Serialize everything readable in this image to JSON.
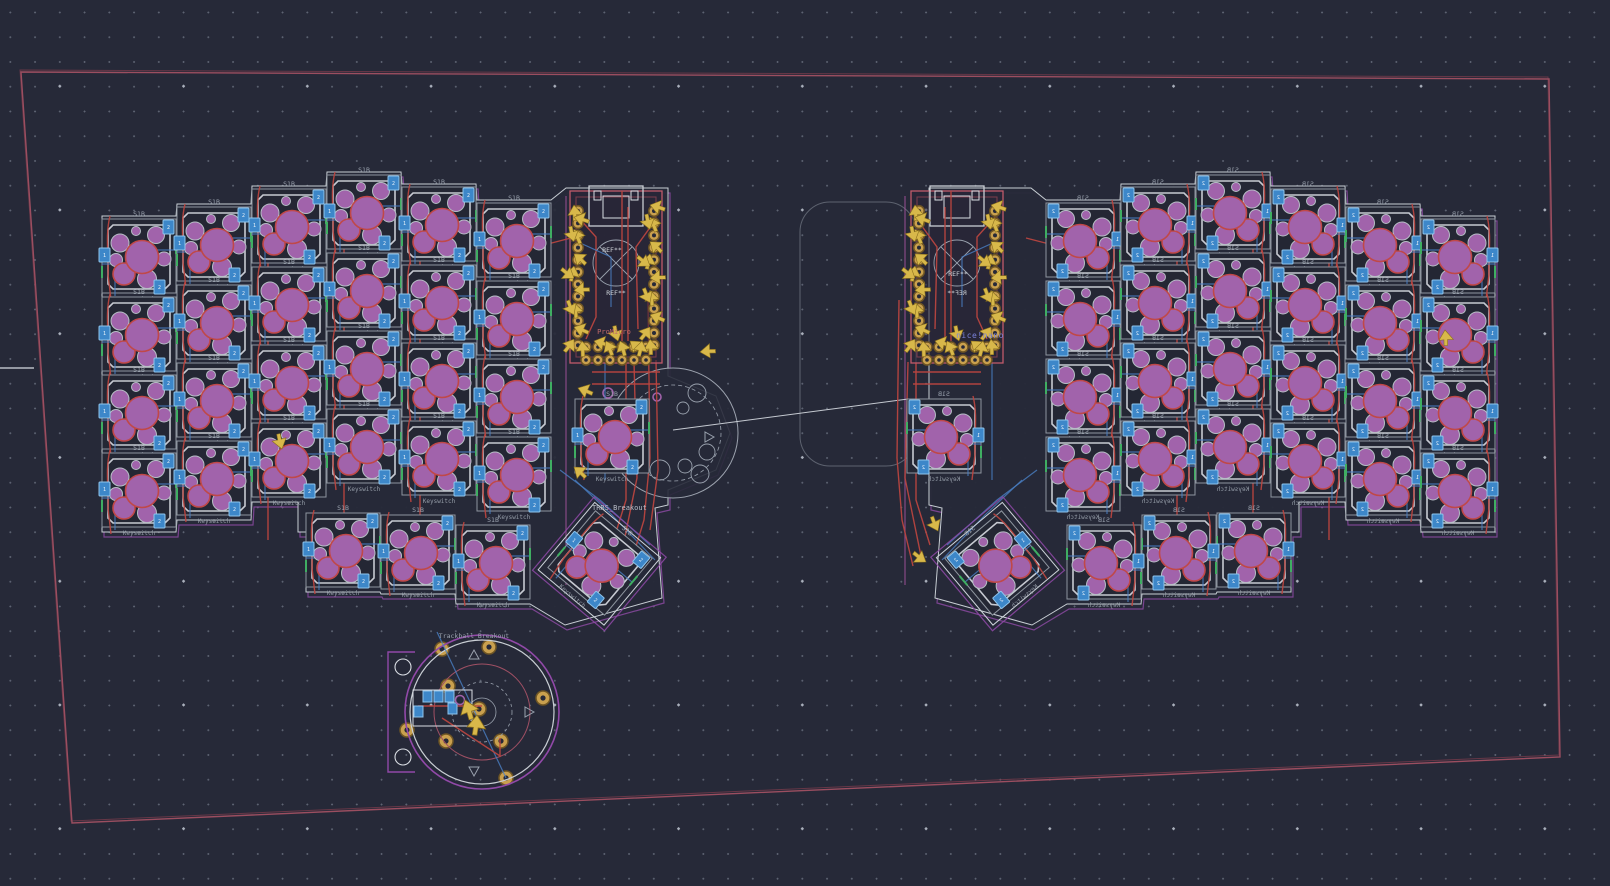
{
  "colors": {
    "background": "#262938",
    "grid_dot": "#5d6372",
    "grid_dot_bright": "#aab0bc",
    "edge_cuts": "#9b4e60",
    "silkscreen": "#d9dde3",
    "courtyard": "#8e959f",
    "pad_purple": "#a163ab",
    "pad_ring_red": "#c04848",
    "pad_blue": "#3d87c9",
    "trace_red": "#b8453f",
    "trace_blue": "#4a80c4",
    "pad_gold": "#c9a04e",
    "ratsnest_yellow": "#d8b84a",
    "outline_violet": "#9149a8"
  },
  "board_outline": {
    "points": "21,72 1549,79 1560,757 72,823"
  },
  "origin_marker": {
    "x1": 0,
    "y1": 368,
    "x2": 34,
    "y2": 368
  },
  "mid_outline": {
    "x": 800,
    "y": 202,
    "width": 116,
    "height": 264,
    "radius": 30
  },
  "ratsnest_line": "673,430 908,399",
  "footprints": {
    "key": {
      "ref_label": "S1B",
      "value_label": "Keyswitch",
      "pad1_label": "1",
      "pad2_label": "2"
    },
    "mcu": {
      "ref_label": "REF**"
    },
    "mcu_left_value": "ProMicro",
    "mcu_right_value": "nice!nano",
    "breakout_label": "TRRS_Breakout",
    "trackball_label": "Trackball_Breakout"
  },
  "left_half": {
    "mirror": false,
    "mcu": {
      "x": 616,
      "y": 277
    },
    "edge_line": "566,196 566,585",
    "outline": "102,216 176,216 177,204 251,204 252,186 326,186 327,172 401,172 402,184 476,184 477,200 551,200 566,188 668,188 668,376 716,396 730,433 716,470 668,490 668,505 655,508 662,598 565,625 530,604 456,604 455,594 381,594 380,592 306,592 306,532 298,532 298,502 252,502 251,520 177,520 176,532 102,532",
    "keys": [
      [
        139,
        256
      ],
      [
        139,
        334
      ],
      [
        139,
        412
      ],
      [
        139,
        490
      ],
      [
        214,
        244
      ],
      [
        214,
        322
      ],
      [
        214,
        400
      ],
      [
        214,
        478
      ],
      [
        289,
        226
      ],
      [
        289,
        304
      ],
      [
        289,
        382
      ],
      [
        289,
        460
      ],
      [
        364,
        212
      ],
      [
        364,
        290
      ],
      [
        364,
        368
      ],
      [
        364,
        446
      ],
      [
        439,
        224
      ],
      [
        439,
        302
      ],
      [
        439,
        380
      ],
      [
        439,
        458
      ],
      [
        514,
        240
      ],
      [
        514,
        318
      ],
      [
        514,
        396
      ],
      [
        514,
        474
      ],
      [
        612,
        436
      ],
      [
        343,
        550
      ],
      [
        418,
        552
      ],
      [
        493,
        562
      ],
      [
        600,
        563,
        40
      ]
    ],
    "traces_red": [
      "268,246 268,540",
      "344,231 344,560",
      "420,218 420,556",
      "626,362 626,500 612,545",
      "634,362 637,478 621,556",
      "648,300 650,458 644,520 630,566",
      "656,360 658,470 650,530",
      "571,238 540,246 522,252",
      "592,372 660,372",
      "592,384 660,384"
    ],
    "traces_blue": [
      "106,300 250,296 340,300 470,302 548,306",
      "106,380 300,376 460,380 548,382",
      "110,458 300,454 470,458 548,460",
      "560,470 600,500 650,545",
      "575,480 612,515 655,560",
      "605,362 605,480"
    ]
  },
  "right_half": {
    "mirror": true,
    "mcu": {
      "x": 957,
      "y": 277
    },
    "edge_line": "905,196 905,585",
    "outline": "1495,216 1421,216 1420,204 1346,204 1345,186 1271,186 1270,172 1196,172 1195,184 1121,184 1120,200 1046,200 1031,188 929,188 929,505 942,508 935,598 1032,625 1067,604 1141,604 1142,594 1216,594 1217,592 1291,592 1291,532 1299,532 1299,502 1345,502 1346,520 1420,520 1421,532 1495,532",
    "keys": [
      [
        1083,
        240
      ],
      [
        1083,
        318
      ],
      [
        1083,
        396
      ],
      [
        1083,
        474
      ],
      [
        1158,
        224
      ],
      [
        1158,
        302
      ],
      [
        1158,
        380
      ],
      [
        1158,
        458
      ],
      [
        1233,
        212
      ],
      [
        1233,
        290
      ],
      [
        1233,
        368
      ],
      [
        1233,
        446
      ],
      [
        1308,
        226
      ],
      [
        1308,
        304
      ],
      [
        1308,
        382
      ],
      [
        1308,
        460
      ],
      [
        1383,
        244
      ],
      [
        1383,
        322
      ],
      [
        1383,
        400
      ],
      [
        1383,
        478
      ],
      [
        1458,
        256
      ],
      [
        1458,
        334
      ],
      [
        1458,
        412
      ],
      [
        1458,
        490
      ],
      [
        944,
        436
      ],
      [
        1254,
        550
      ],
      [
        1179,
        552
      ],
      [
        1104,
        562
      ],
      [
        997,
        563,
        -40
      ]
    ],
    "traces_red": [
      "1329,246 1329,540",
      "1253,231 1253,560",
      "1177,218 1177,556",
      "916,362 916,500 930,545",
      "908,362 905,478 921,556",
      "899,300 897,458 902,520 913,566",
      "1026,238 1057,246 1075,252",
      "913,372 981,372",
      "913,384 981,384"
    ],
    "traces_blue": [
      "1491,300 1347,296 1257,300 1127,302 1049,306",
      "1491,380 1297,376 1137,380 1049,382",
      "1487,458 1297,454 1127,458 1049,460",
      "1037,470 997,500 947,545",
      "1022,480 985,515 942,560",
      "992,362 992,480"
    ]
  },
  "left_circle": {
    "cx": 673,
    "cy": 433,
    "r": 65,
    "r_inner": 48,
    "small_circles": [
      [
        697,
        393,
        9
      ],
      [
        683,
        408,
        6
      ],
      [
        707,
        452,
        8
      ],
      [
        685,
        466,
        7
      ],
      [
        700,
        474,
        9
      ],
      [
        660,
        470,
        10
      ]
    ],
    "vias": [
      [
        608,
        393,
        5
      ],
      [
        607,
        464,
        5
      ],
      [
        657,
        397,
        4
      ]
    ],
    "label_x": 592,
    "label_y": 510
  },
  "bottom_trackball": {
    "cx": 482,
    "cy": 712
  },
  "stray_arrows": [
    [
      578,
      388,
      -35
    ],
    [
      574,
      467,
      -15
    ],
    [
      282,
      449,
      200
    ],
    [
      620,
      341,
      15
    ],
    [
      938,
      531,
      190
    ],
    [
      926,
      562,
      160
    ],
    [
      700,
      352,
      -60
    ],
    [
      1445,
      330,
      30
    ]
  ],
  "text_positions": {
    "mcu_left_ref": [
      612,
      252
    ],
    "mcu_left_val": [
      614,
      334
    ],
    "mcu_right_ref": [
      958,
      276
    ],
    "mcu_right_val": [
      980,
      338
    ]
  }
}
